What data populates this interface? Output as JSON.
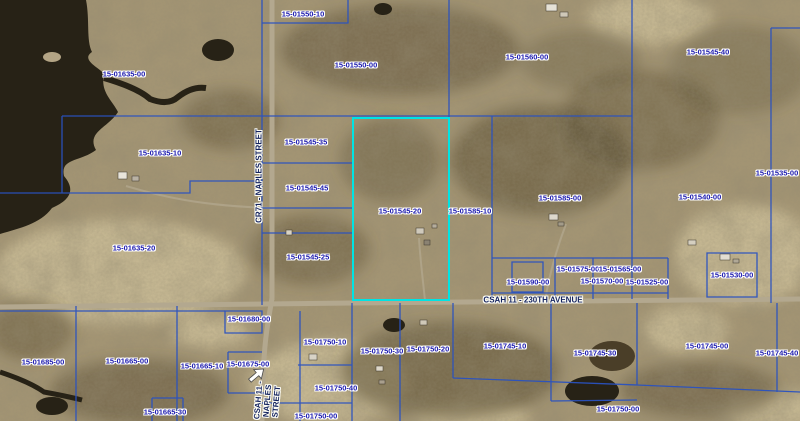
{
  "colors": {
    "base": "#a59674",
    "water": "#272216",
    "road": "#b3a88f",
    "boundary": "#2a52c0",
    "highlight": "#00e4e4",
    "parcel_label": "#1a18ad",
    "road_label": "#14235f"
  },
  "highlighted_parcel": {
    "id": "15-01545-20",
    "x": 352,
    "y": 117,
    "width": 98,
    "height": 184
  },
  "parcel_labels": [
    {
      "id": "15-01635-00",
      "x": 124,
      "y": 74
    },
    {
      "id": "15-01550-10",
      "x": 303,
      "y": 14
    },
    {
      "id": "15-01550-00",
      "x": 356,
      "y": 65
    },
    {
      "id": "15-01560-00",
      "x": 527,
      "y": 57
    },
    {
      "id": "15-01545-40",
      "x": 708,
      "y": 52
    },
    {
      "id": "15-01635-10",
      "x": 160,
      "y": 153
    },
    {
      "id": "15-01545-35",
      "x": 306,
      "y": 142
    },
    {
      "id": "15-01545-45",
      "x": 307,
      "y": 188
    },
    {
      "id": "15-01545-20",
      "x": 400,
      "y": 211
    },
    {
      "id": "15-01585-10",
      "x": 470,
      "y": 211
    },
    {
      "id": "15-01585-00",
      "x": 560,
      "y": 198
    },
    {
      "id": "15-01535-00",
      "x": 777,
      "y": 173
    },
    {
      "id": "15-01540-00",
      "x": 700,
      "y": 197
    },
    {
      "id": "15-01635-20",
      "x": 134,
      "y": 248
    },
    {
      "id": "15-01545-25",
      "x": 308,
      "y": 257
    },
    {
      "id": "15-01575-00",
      "x": 578,
      "y": 269
    },
    {
      "id": "15-01565-00",
      "x": 620,
      "y": 269
    },
    {
      "id": "15-01590-00",
      "x": 528,
      "y": 282
    },
    {
      "id": "15-01570-00",
      "x": 602,
      "y": 281
    },
    {
      "id": "15-01525-00",
      "x": 647,
      "y": 282
    },
    {
      "id": "15-01530-00",
      "x": 732,
      "y": 275
    },
    {
      "id": "15-01680-00",
      "x": 249,
      "y": 319
    },
    {
      "id": "15-01750-10",
      "x": 325,
      "y": 342
    },
    {
      "id": "15-01750-30",
      "x": 382,
      "y": 351
    },
    {
      "id": "15-01750-20",
      "x": 428,
      "y": 349
    },
    {
      "id": "15-01745-10",
      "x": 505,
      "y": 346
    },
    {
      "id": "15-01685-00",
      "x": 43,
      "y": 362
    },
    {
      "id": "15-01665-00",
      "x": 127,
      "y": 361
    },
    {
      "id": "15-01665-10",
      "x": 202,
      "y": 366
    },
    {
      "id": "15-01675-00",
      "x": 248,
      "y": 364
    },
    {
      "id": "15-01745-30",
      "x": 595,
      "y": 353
    },
    {
      "id": "15-01745-00",
      "x": 707,
      "y": 346
    },
    {
      "id": "15-01745-40",
      "x": 777,
      "y": 353
    },
    {
      "id": "15-01750-40",
      "x": 336,
      "y": 388
    },
    {
      "id": "15-01665-30",
      "x": 165,
      "y": 412
    },
    {
      "id": "15-01750-00",
      "x": 316,
      "y": 416
    },
    {
      "id": "15-01750-00",
      "x": 618,
      "y": 409
    }
  ],
  "road_labels": [
    {
      "name": "csah-11-230th-avenue",
      "lines": [
        "CSAH 11 - 230TH AVENUE"
      ],
      "x": 533,
      "y": 301,
      "rotate": 0
    },
    {
      "name": "cr71-naples-street",
      "lines": [
        "CR71 - NAPLES STREET"
      ],
      "x": 260,
      "y": 176,
      "rotate": -90
    },
    {
      "name": "csah-11-naples-street",
      "lines": [
        "CSAH 11 -",
        "NAPLES",
        "STREET"
      ],
      "x": 268,
      "y": 401,
      "rotate": -85
    }
  ]
}
